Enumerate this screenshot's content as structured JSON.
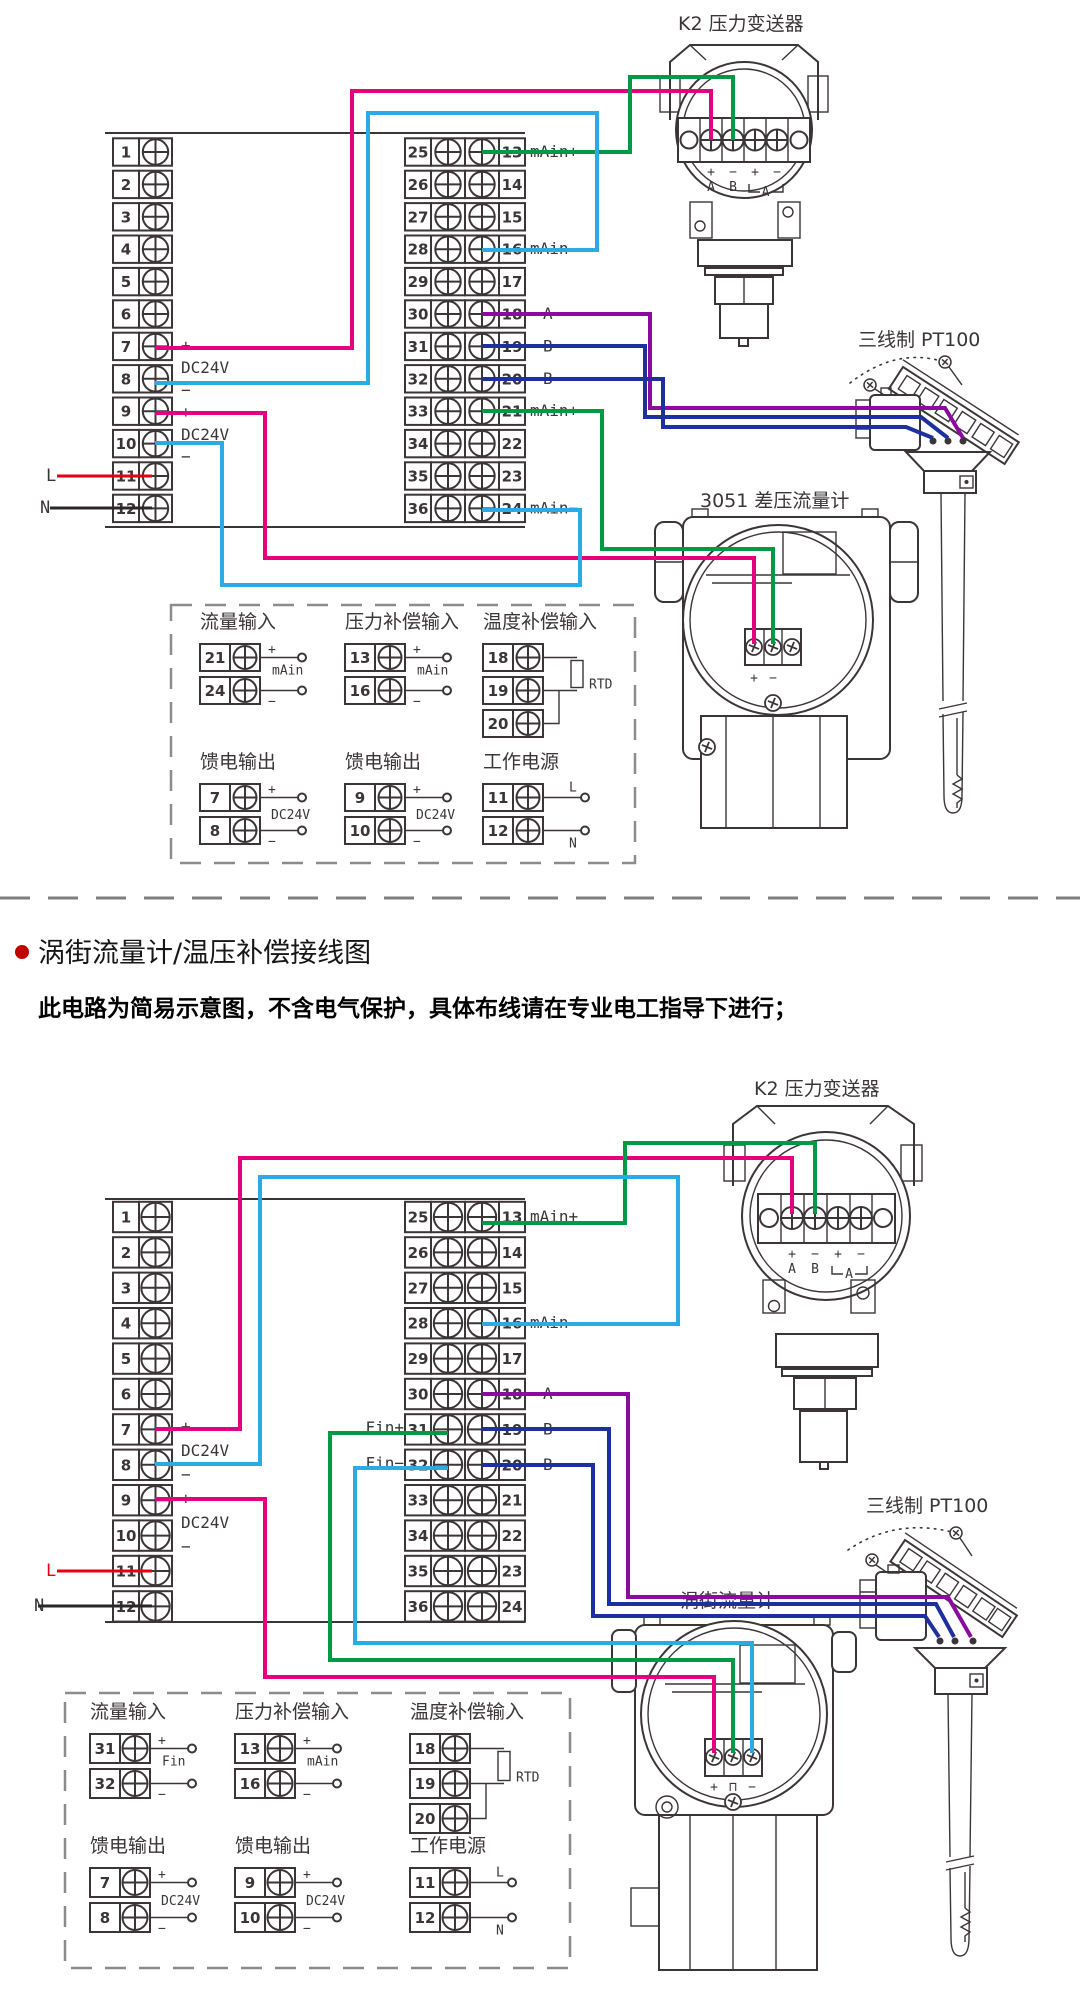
{
  "colors": {
    "line": "#3c3537",
    "wire_magenta": "#e5007e",
    "wire_cyan": "#2aabe3",
    "wire_green": "#009a44",
    "wire_purple": "#8a0b9e",
    "wire_navy": "#1e2f9e",
    "wire_red": "#e60012",
    "bullet_red": "#c00000",
    "dash_gray": "#8c8c8c"
  },
  "section": {
    "title": "涡街流量计/温压补偿接线图",
    "note": "此电路为简易示意图，不含电气保护，具体布线请在专业电工指导下进行；"
  },
  "common": {
    "plus": "+",
    "minus": "−",
    "dc24v": "DC24V",
    "l_label": "L",
    "n_label": "N",
    "dc_stack": [
      "+",
      "DC24V",
      "−",
      "+",
      "DC24V",
      "−"
    ]
  },
  "terminals": {
    "left": [
      "1",
      "2",
      "3",
      "4",
      "5",
      "6",
      "7",
      "8",
      "9",
      "10",
      "11",
      "12"
    ],
    "mid_left": [
      "25",
      "26",
      "27",
      "28",
      "29",
      "30",
      "31",
      "32",
      "33",
      "34",
      "35",
      "36"
    ],
    "mid_right": [
      "13",
      "14",
      "15",
      "16",
      "17",
      "18",
      "19",
      "20",
      "21",
      "22",
      "23",
      "24"
    ]
  },
  "k2": {
    "signs": [
      "+",
      "−",
      "+",
      "−"
    ],
    "ab": [
      "A",
      "B"
    ],
    "bracket": "A"
  },
  "d1": {
    "k2_title": "K2 压力变送器",
    "pt100_title": "三线制 PT100",
    "meter_title": "3051 差压流量计",
    "meter_signs": [
      "+",
      "−"
    ],
    "right_labels": [
      "mAin+",
      "",
      "",
      "mAin−",
      "",
      "",
      "",
      "",
      "mAin+",
      "",
      "",
      "mAin−"
    ],
    "ab_labels": [
      "A",
      "B",
      "B"
    ],
    "legend": {
      "groups": [
        {
          "kind": "loop",
          "title": "流量输入",
          "rows": [
            "21",
            "24"
          ],
          "sign_top": "+",
          "sign_bottom": "−",
          "tag": "mAin"
        },
        {
          "kind": "loop",
          "title": "压力补偿输入",
          "rows": [
            "13",
            "16"
          ],
          "sign_top": "+",
          "sign_bottom": "−",
          "tag": "mAin"
        },
        {
          "kind": "rtd",
          "title": "温度补偿输入",
          "rows": [
            "18",
            "19",
            "20"
          ],
          "tag": "RTD"
        },
        {
          "kind": "feed",
          "title": "馈电输出",
          "rows": [
            "7",
            "8"
          ],
          "sign_top": "+",
          "sign_bottom": "−",
          "tag": "DC24V"
        },
        {
          "kind": "feed",
          "title": "馈电输出",
          "rows": [
            "9",
            "10"
          ],
          "sign_top": "+",
          "sign_bottom": "−",
          "tag": "DC24V"
        },
        {
          "kind": "power",
          "title": "工作电源",
          "rows": [
            "11",
            "12"
          ],
          "tag_top": "L",
          "tag_bottom": "N"
        }
      ]
    }
  },
  "d2": {
    "k2_title": "K2 压力变送器",
    "pt100_title": "三线制 PT100",
    "meter_title": "涡街流量计",
    "meter_signs": [
      "+",
      "⊓",
      "−"
    ],
    "right_labels": [
      "mAin+",
      "",
      "",
      "mAin−",
      "",
      "",
      "",
      "",
      "",
      "",
      "",
      ""
    ],
    "ab_labels": [
      "A",
      "B",
      "B"
    ],
    "fin_labels": [
      "Fin+",
      "Fin−"
    ],
    "legend": {
      "groups": [
        {
          "kind": "loop",
          "title": "流量输入",
          "rows": [
            "31",
            "32"
          ],
          "sign_top": "+",
          "sign_bottom": "−",
          "tag": "Fin"
        },
        {
          "kind": "loop",
          "title": "压力补偿输入",
          "rows": [
            "13",
            "16"
          ],
          "sign_top": "+",
          "sign_bottom": "−",
          "tag": "mAin"
        },
        {
          "kind": "rtd",
          "title": "温度补偿输入",
          "rows": [
            "18",
            "19",
            "20"
          ],
          "tag": "RTD"
        },
        {
          "kind": "feed",
          "title": "馈电输出",
          "rows": [
            "7",
            "8"
          ],
          "sign_top": "+",
          "sign_bottom": "−",
          "tag": "DC24V"
        },
        {
          "kind": "feed",
          "title": "馈电输出",
          "rows": [
            "9",
            "10"
          ],
          "sign_top": "+",
          "sign_bottom": "−",
          "tag": "DC24V"
        },
        {
          "kind": "power",
          "title": "工作电源",
          "rows": [
            "11",
            "12"
          ],
          "tag_top": "L",
          "tag_bottom": "N"
        }
      ]
    }
  }
}
